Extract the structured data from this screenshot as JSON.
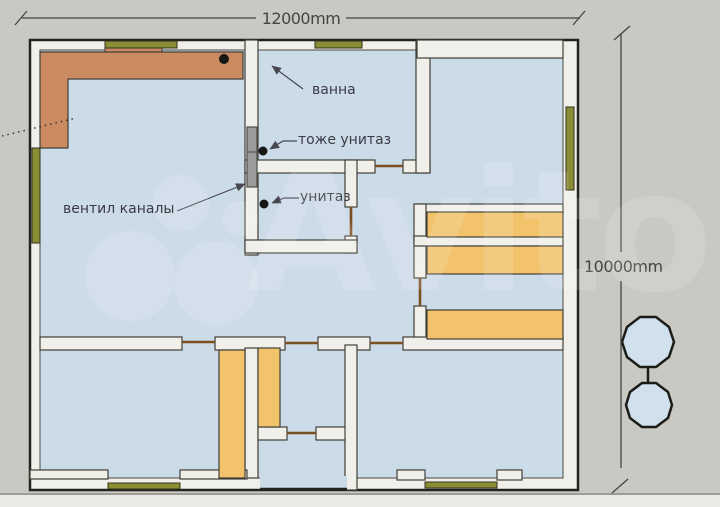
{
  "plan": {
    "dimension_width": "12000mm",
    "dimension_height": "10000mm",
    "labels": {
      "bath": "ванна",
      "also_toilet": "тоже унитаз",
      "toilet": "унитаз",
      "vent_channels": "вентил каналы"
    }
  },
  "watermark": {
    "text": "Avito"
  },
  "colors": {
    "background": "#c9c8c2",
    "floor": "#ccdbe8",
    "wall": "#f1efe9",
    "counter": "#cc8a60",
    "cabinet": "#f2c36b",
    "window": "#8a8d33",
    "door": "#7c4f21",
    "vent": "#9b9b9b",
    "tree": "#d0e0ec",
    "outline": "#22221e",
    "dimension": "#45453f",
    "label": "#3b3b44"
  }
}
